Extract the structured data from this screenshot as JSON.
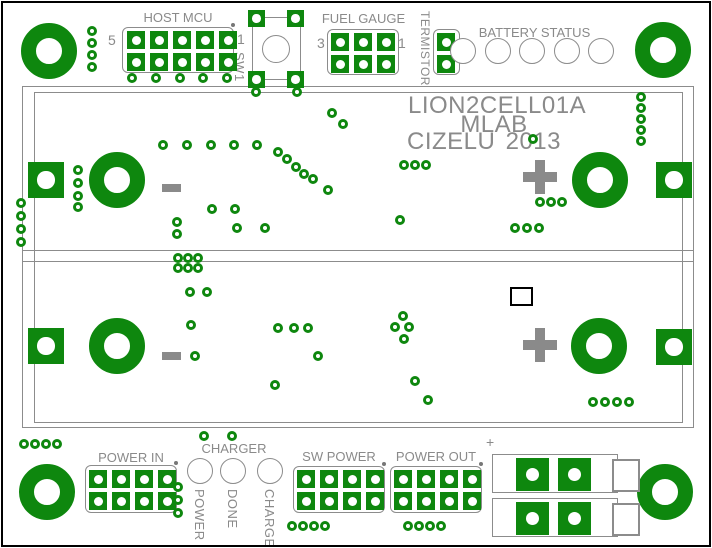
{
  "board": {
    "title": {
      "line1": "LION2CELL01A",
      "line2": "MLAB",
      "line3_left": "CIZELU",
      "line3_right": "2013"
    }
  },
  "colors": {
    "copper_green": "#0e870e",
    "silk_gray": "#8c8c8c",
    "text_gray": "#8a8a8a",
    "board_white": "#ffffff",
    "frame_black": "#000000"
  },
  "labels": {
    "host_mcu": "HOST MCU",
    "host_pin_left": "5",
    "host_pin_right": "1",
    "sw1": "SW1",
    "fuel_gauge": "FUEL GAUGE",
    "fuel_pin_left": "3",
    "fuel_pin_right": "1",
    "termistor": "TERMISTOR",
    "battery_status": "BATTERY STATUS",
    "power_in": "POWER IN",
    "charger": "CHARGER",
    "charger_led1": "POWER",
    "charger_led2": "DONE",
    "charger_led3": "CHARGE",
    "sw_power": "SW POWER",
    "power_out": "POWER OUT",
    "terminal_plus": "+"
  },
  "geometry": {
    "donuts": [
      {
        "x": 49,
        "y": 51,
        "n": "mounting-hole-top-left"
      },
      {
        "x": 663,
        "y": 50,
        "n": "mounting-hole-top-right"
      },
      {
        "x": 47,
        "y": 492,
        "n": "mounting-hole-bottom-left"
      },
      {
        "x": 665,
        "y": 492,
        "n": "mounting-hole-bottom-right"
      },
      {
        "x": 117,
        "y": 180,
        "n": "cell1-negative-hole"
      },
      {
        "x": 600,
        "y": 180,
        "n": "cell1-positive-hole"
      },
      {
        "x": 117,
        "y": 346,
        "n": "cell2-negative-hole"
      },
      {
        "x": 599,
        "y": 346,
        "n": "cell2-positive-hole"
      }
    ],
    "contact_pads": [
      {
        "x": 28,
        "y": 162
      },
      {
        "x": 656,
        "y": 162
      },
      {
        "x": 28,
        "y": 328
      },
      {
        "x": 656,
        "y": 329
      }
    ],
    "headers": [
      {
        "id": "host-mcu-header",
        "x": 122,
        "y": 27,
        "w": 112,
        "h": 46,
        "cols": 5,
        "rows": 2,
        "px": 127,
        "py": 31,
        "dot": 1
      },
      {
        "id": "fuel-gauge-header",
        "x": 327,
        "y": 29,
        "w": 72,
        "h": 46,
        "cols": 3,
        "rows": 2,
        "px": 331,
        "py": 33,
        "dot": 0
      },
      {
        "id": "termistor-header",
        "x": 433,
        "y": 29,
        "w": 27,
        "h": 46,
        "cols": 1,
        "rows": 2,
        "px": 437,
        "py": 33,
        "dot": 0
      },
      {
        "id": "power-in-header",
        "x": 85,
        "y": 465,
        "w": 92,
        "h": 48,
        "cols": 4,
        "rows": 2,
        "px": 89,
        "py": 470,
        "dot": 1
      },
      {
        "id": "sw-power-header",
        "x": 293,
        "y": 466,
        "w": 92,
        "h": 47,
        "cols": 4,
        "rows": 2,
        "px": 297,
        "py": 470,
        "dot": 1
      },
      {
        "id": "power-out-header",
        "x": 390,
        "y": 466,
        "w": 92,
        "h": 47,
        "cols": 4,
        "rows": 2,
        "px": 394,
        "py": 470,
        "dot": 1
      }
    ],
    "sw1": {
      "pads": [
        [
          248,
          10
        ],
        [
          287,
          10
        ],
        [
          248,
          71
        ],
        [
          287,
          71
        ]
      ],
      "pad": 17,
      "circle": {
        "x": 262,
        "y": 35,
        "d": 28
      },
      "bracket": {
        "x": 252,
        "y": 17,
        "w": 49,
        "h": 63
      }
    },
    "status_leds": {
      "xs": [
        463,
        498,
        532,
        567,
        601
      ],
      "y": 38
    },
    "charger_leds": {
      "xs": [
        200,
        233,
        270
      ],
      "y": 458
    },
    "terminal": {
      "rects": [
        {
          "x": 492,
          "y": 454,
          "w": 126,
          "h": 39
        },
        {
          "x": 492,
          "y": 498,
          "w": 126,
          "h": 39
        }
      ],
      "pads": [
        [
          516,
          458
        ],
        [
          558,
          458
        ],
        [
          516,
          502
        ],
        [
          558,
          502
        ]
      ],
      "squares": [
        {
          "x": 612,
          "y": 459,
          "w": 24,
          "h": 29
        },
        {
          "x": 612,
          "y": 503,
          "w": 24,
          "h": 29
        }
      ]
    },
    "fiducial": {
      "x": 510,
      "y": 287,
      "w": 19,
      "h": 15
    },
    "polarity": {
      "minus": [
        [
          162,
          184
        ],
        [
          162,
          352
        ]
      ],
      "minus_w": 19,
      "minus_h": 8,
      "plus": [
        [
          540,
          177
        ],
        [
          540,
          345
        ]
      ],
      "plus_len": 34,
      "plus_th": 10
    },
    "vias": [
      [
        92,
        31
      ],
      [
        92,
        43
      ],
      [
        92,
        55
      ],
      [
        92,
        67
      ],
      [
        132,
        78
      ],
      [
        156,
        78
      ],
      [
        180,
        78
      ],
      [
        203,
        78
      ],
      [
        227,
        78
      ],
      [
        256,
        92
      ],
      [
        297,
        92
      ],
      [
        163,
        145
      ],
      [
        187,
        145
      ],
      [
        211,
        145
      ],
      [
        234,
        145
      ],
      [
        257,
        145
      ],
      [
        278,
        152
      ],
      [
        287,
        159
      ],
      [
        296,
        167
      ],
      [
        304,
        174
      ],
      [
        313,
        179
      ],
      [
        328,
        190
      ],
      [
        332,
        113
      ],
      [
        343,
        124
      ],
      [
        533,
        139
      ],
      [
        641,
        97
      ],
      [
        641,
        108
      ],
      [
        641,
        119
      ],
      [
        641,
        130
      ],
      [
        641,
        141
      ],
      [
        21,
        203
      ],
      [
        21,
        216
      ],
      [
        21,
        229
      ],
      [
        21,
        242
      ],
      [
        78,
        170
      ],
      [
        78,
        183
      ],
      [
        78,
        196
      ],
      [
        78,
        207
      ],
      [
        212,
        209
      ],
      [
        235,
        209
      ],
      [
        177,
        222
      ],
      [
        177,
        234
      ],
      [
        237,
        228
      ],
      [
        265,
        228
      ],
      [
        404,
        165
      ],
      [
        415,
        165
      ],
      [
        426,
        165
      ],
      [
        400,
        220
      ],
      [
        540,
        202
      ],
      [
        551,
        202
      ],
      [
        562,
        202
      ],
      [
        515,
        228
      ],
      [
        527,
        228
      ],
      [
        539,
        228
      ],
      [
        178,
        258
      ],
      [
        188,
        258
      ],
      [
        198,
        258
      ],
      [
        178,
        268
      ],
      [
        188,
        268
      ],
      [
        198,
        268
      ],
      [
        190,
        292
      ],
      [
        207,
        292
      ],
      [
        191,
        325
      ],
      [
        195,
        356
      ],
      [
        278,
        328
      ],
      [
        294,
        328
      ],
      [
        308,
        328
      ],
      [
        318,
        356
      ],
      [
        275,
        385
      ],
      [
        403,
        316
      ],
      [
        395,
        327
      ],
      [
        409,
        327
      ],
      [
        404,
        339
      ],
      [
        415,
        381
      ],
      [
        428,
        400
      ],
      [
        593,
        402
      ],
      [
        605,
        402
      ],
      [
        617,
        402
      ],
      [
        629,
        402
      ],
      [
        204,
        436
      ],
      [
        232,
        436
      ],
      [
        24,
        444
      ],
      [
        35,
        444
      ],
      [
        46,
        444
      ],
      [
        57,
        444
      ],
      [
        178,
        487
      ],
      [
        178,
        500
      ],
      [
        178,
        513
      ],
      [
        292,
        526
      ],
      [
        303,
        526
      ],
      [
        314,
        526
      ],
      [
        325,
        526
      ],
      [
        408,
        526
      ],
      [
        419,
        526
      ],
      [
        430,
        526
      ],
      [
        441,
        526
      ]
    ]
  }
}
